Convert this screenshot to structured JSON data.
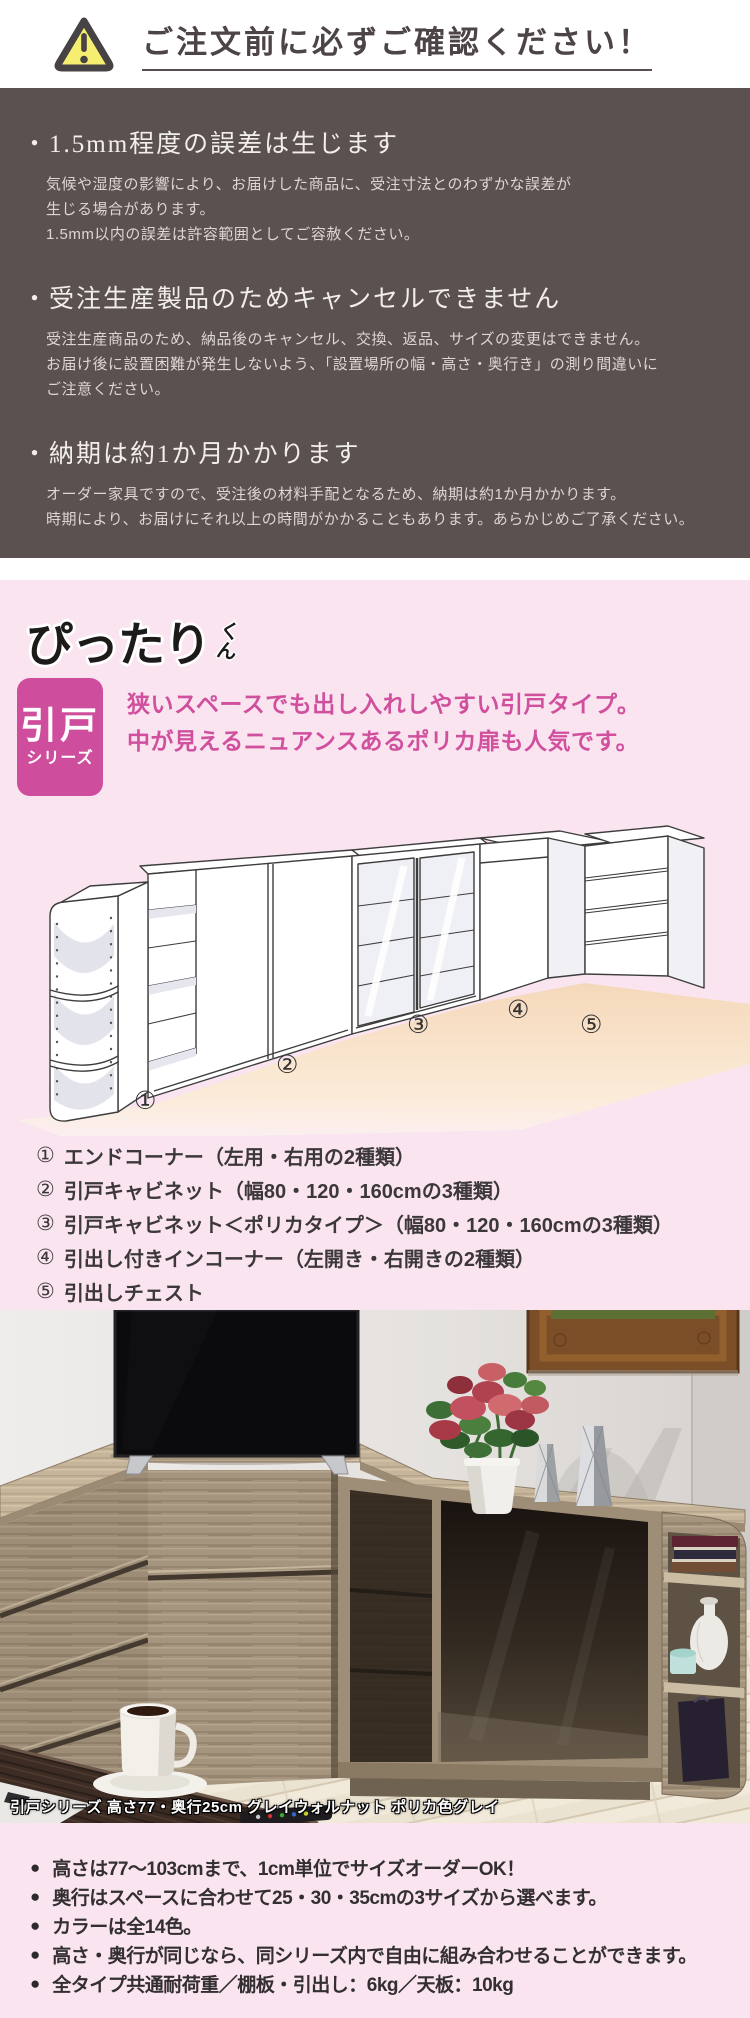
{
  "notice": {
    "title": "ご注文前に必ずご確認ください！",
    "items": [
      {
        "heading": "・1.5mm程度の誤差は生じます",
        "body": "気候や湿度の影響により、お届けした商品に、受注寸法とのわずかな誤差が\n生じる場合があります。\n1.5mm以内の誤差は許容範囲としてご容赦ください。"
      },
      {
        "heading": "・受注生産製品のためキャンセルできません",
        "body": "受注生産商品のため、納品後のキャンセル、交換、返品、サイズの変更はできません。\nお届け後に設置困難が発生しないよう、「設置場所の幅・高さ・奥行き」の測り間違いに\nご注意ください。"
      },
      {
        "heading": "・納期は約1か月かかります",
        "body": "オーダー家具ですので、受注後の材料手配となるため、納期は約1か月かかります。\n時期により、お届けにそれ以上の時間がかかることもあります。あらかじめご了承ください。"
      }
    ]
  },
  "series": {
    "logo_main": "ぴったり",
    "logo_suffix": "くん",
    "badge_line1": "引戸",
    "badge_line2": "シリーズ",
    "catch": "狭いスペースでも出し入れしやすい引戸タイプ。\n中が見えるニュアンスあるポリカ扉も人気です。"
  },
  "illustration": {
    "labels": [
      "①",
      "②",
      "③",
      "④",
      "⑤"
    ]
  },
  "lineup": {
    "items": [
      {
        "num": "①",
        "label": "エンドコーナー（左用・右用の2種類）"
      },
      {
        "num": "②",
        "label": "引戸キャビネット（幅80・120・160cmの3種類）"
      },
      {
        "num": "③",
        "label": "引戸キャビネット＜ポリカタイプ＞（幅80・120・160cmの3種類）"
      },
      {
        "num": "④",
        "label": "引出し付きインコーナー（左開き・右開きの2種類）"
      },
      {
        "num": "⑤",
        "label": "引出しチェスト"
      }
    ]
  },
  "photo": {
    "caption": "引戸シリーズ 高さ77・奥行25cm グレイウォルナット ポリカ色グレイ"
  },
  "features": {
    "marker": "●",
    "bullets": [
      "高さは77～103cmまで、1cm単位でサイズオーダーOK！",
      "奥行はスペースに合わせて25・30・35cmの3サイズから選べます。",
      "カラーは全14色。",
      "高さ・奥行が同じなら、同シリーズ内で自由に組み合わせることができます。",
      "全タイプ共通耐荷重／棚板・引出し：6kg／天板：10kg"
    ]
  },
  "colors": {
    "notice_bg": "#5b5150",
    "pink_bg": "#f9e4f0",
    "accent_magenta": "#cf4d9d",
    "warning_yellow": "#f6ee71"
  }
}
